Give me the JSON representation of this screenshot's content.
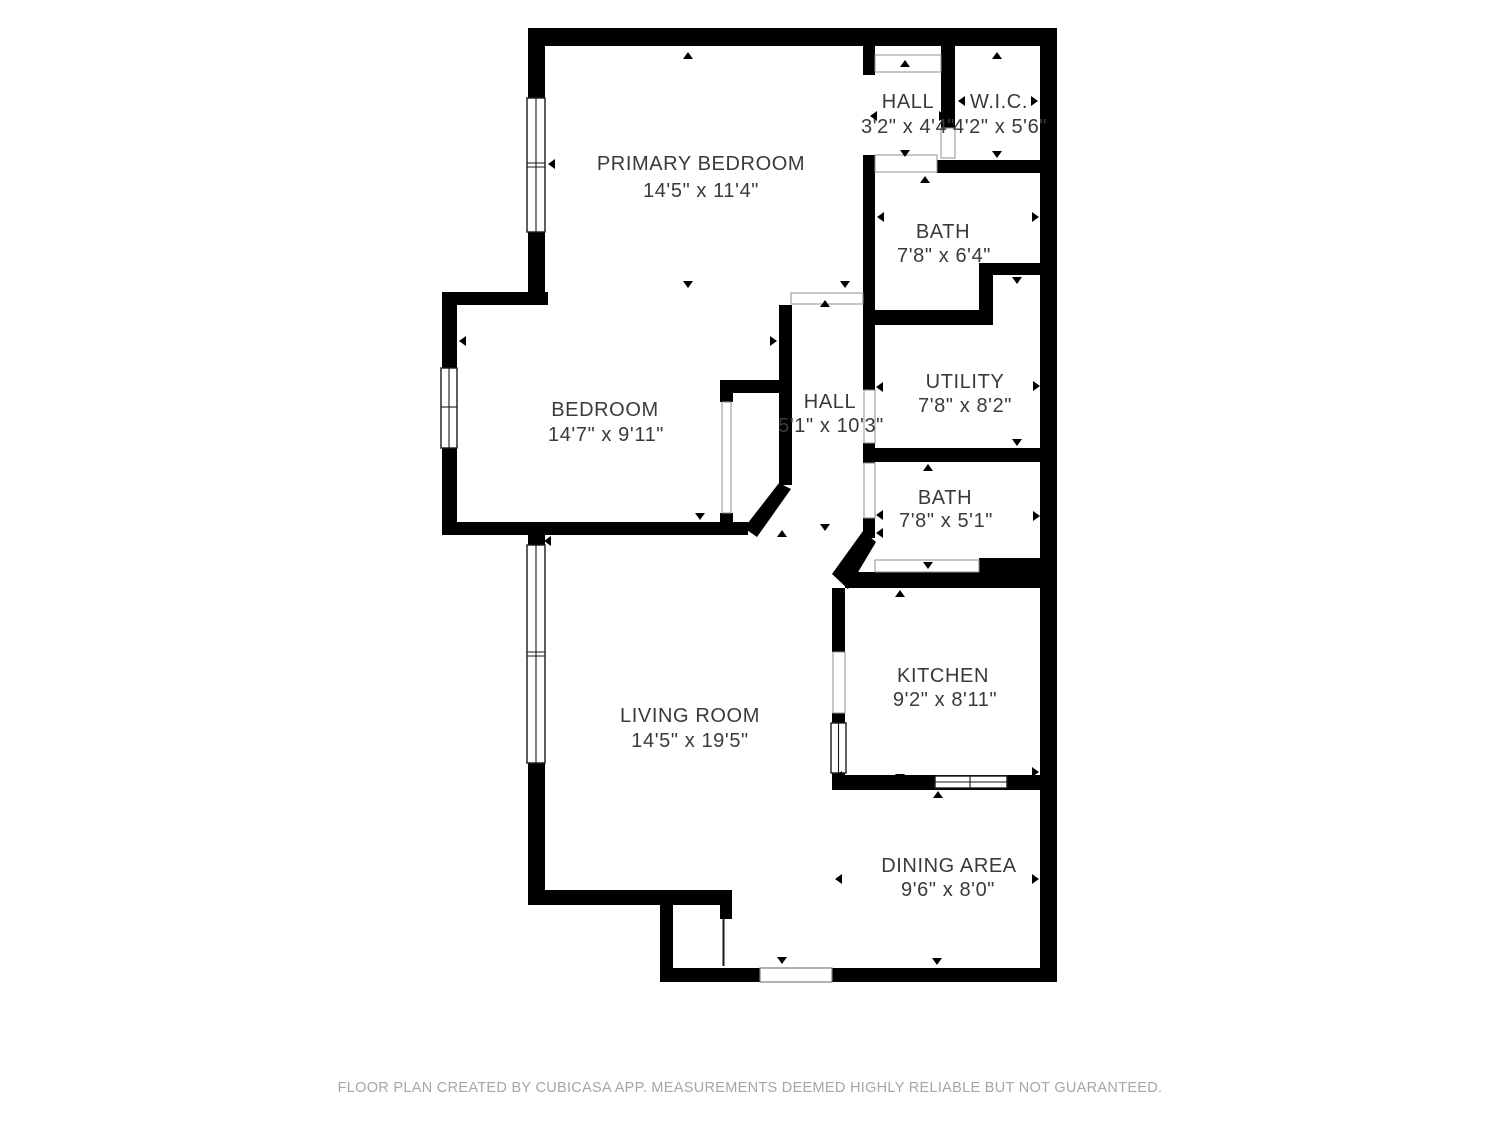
{
  "plan": {
    "footer": "FLOOR PLAN CREATED BY CUBICASA APP. MEASUREMENTS DEEMED HIGHLY RELIABLE BUT NOT GUARANTEED.",
    "colors": {
      "wall": "#000000",
      "label_text": "#3a3a3a",
      "footer_text": "#a6a6a6",
      "background": "#ffffff"
    },
    "rooms": [
      {
        "name": "PRIMARY BEDROOM",
        "dims": "14'5\" x 11'4\""
      },
      {
        "name": "HALL",
        "dims": "3'2\" x 4'4\""
      },
      {
        "name": "W.I.C.",
        "dims": "4'2\" x 5'6\""
      },
      {
        "name": "BATH",
        "dims": "7'8\" x 6'4\""
      },
      {
        "name": "BEDROOM",
        "dims": "14'7\" x 9'11\""
      },
      {
        "name": "HALL",
        "dims": "5'1\" x 10'3\""
      },
      {
        "name": "UTILITY",
        "dims": "7'8\" x 8'2\""
      },
      {
        "name": "BATH",
        "dims": "7'8\" x 5'1\""
      },
      {
        "name": "KITCHEN",
        "dims": "9'2\" x 8'11\""
      },
      {
        "name": "LIVING ROOM",
        "dims": "14'5\" x 19'5\""
      },
      {
        "name": "DINING AREA",
        "dims": "9'6\" x 8'0\""
      }
    ]
  }
}
